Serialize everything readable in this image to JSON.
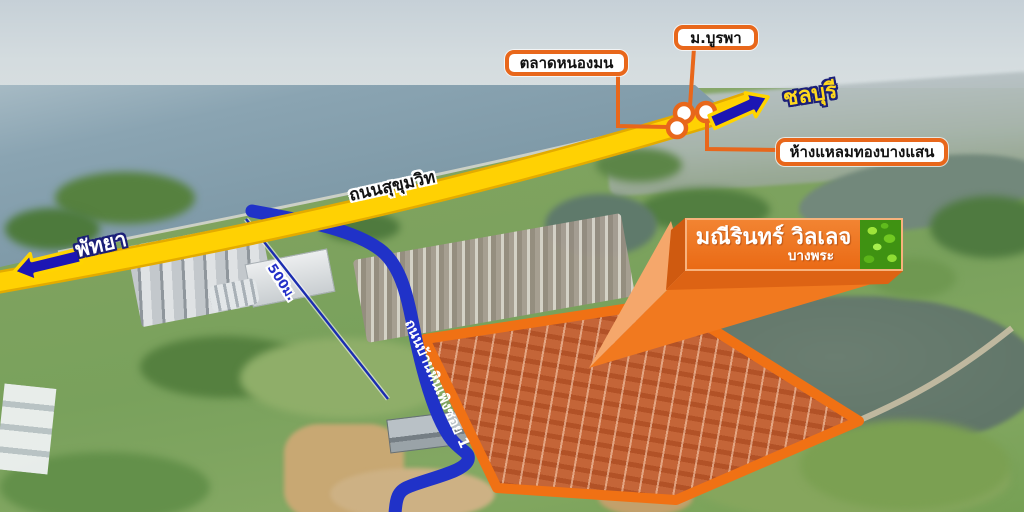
{
  "map": {
    "landmarks": {
      "burapha": "ม.บูรพา",
      "nongmon": "ตลาดหนองมน",
      "laemthong": "ห้างแหลมทองบางแสน"
    },
    "directions": {
      "chonburi": "ชลบุรี",
      "pattaya": "พัทยา"
    },
    "roads": {
      "sukhumvit": "ถนนสุขุมวิท",
      "soi": "ถนนบ้านหินเพิงซอย 1"
    },
    "distance_label": "500ม.",
    "project": {
      "name": "มณีรินทร์ วิลเลจ",
      "location": "บางพระ"
    },
    "markers": {
      "count": 3,
      "style": "white dot with orange ring"
    },
    "colors": {
      "accent_orange": "#ee6f1e",
      "road_yellow": "#ffd103",
      "road_blue": "#2032c8",
      "arrow_navy": "#1c16b4",
      "label_text": "#111111",
      "site_fill": "#bc6440"
    }
  }
}
